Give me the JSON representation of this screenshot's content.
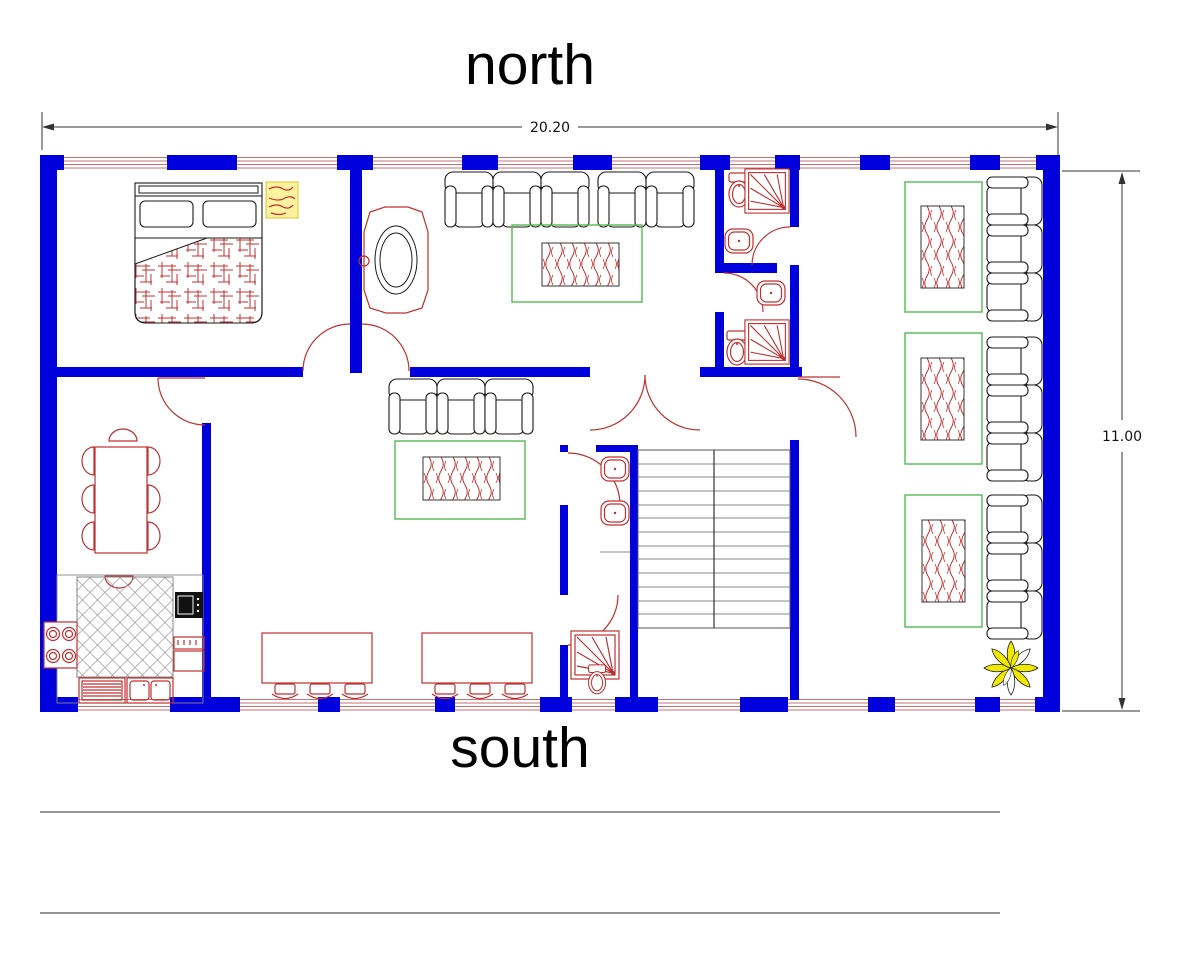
{
  "page": {
    "kind": "architectural-floor-plan-drawing"
  },
  "labels": {
    "north": "north",
    "south": "south"
  },
  "dimensions": {
    "width": "20.20",
    "height": "11.00"
  },
  "colors": {
    "wall_blue": "#0000dd",
    "window_red": "#c87070",
    "furniture_red": "#c03030",
    "carpet_green": "#55b855",
    "outline_black": "#1a1a1a",
    "plant_yellow": "#f0e800",
    "hatch_gray": "#999999",
    "text_black": "#000000",
    "background": "#ffffff"
  },
  "furniture_inventory": {
    "bedroom": [
      "double-bed",
      "rug"
    ],
    "living_room": [
      "5 armchairs",
      "side-table",
      "coffee-table-on-carpet"
    ],
    "family_room": [
      "3 armchairs",
      "coffee-table-on-carpet",
      "2 desks with 3 stools each"
    ],
    "salon": [
      "9 armchairs",
      "3 coffee-tables-on-carpets",
      "plant"
    ],
    "kitchen": [
      "stove",
      "oven",
      "counter",
      "dish-rack",
      "double-sink"
    ],
    "dining": [
      "table with 8 chairs"
    ],
    "bathrooms": [
      "toilets",
      "sinks",
      "showers"
    ],
    "stairwell": [
      "staircase"
    ]
  }
}
